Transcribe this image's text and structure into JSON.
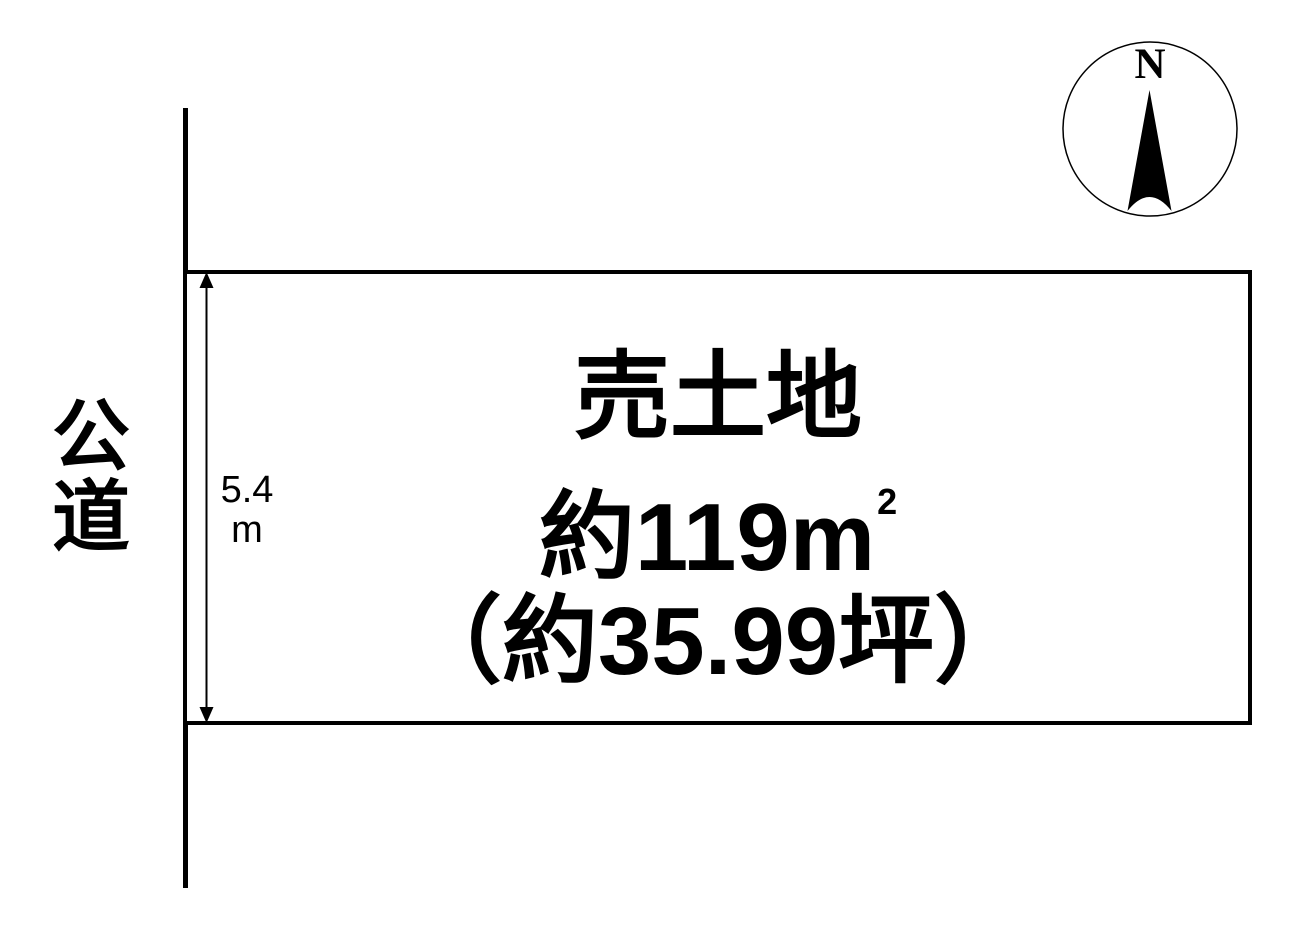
{
  "plot": {
    "title": "売土地",
    "area_main": "約119m",
    "area_sup": "2",
    "area_tsubo": "（約35.99坪）"
  },
  "road": {
    "label": "公道"
  },
  "dimension": {
    "value": "5.4",
    "unit": "m"
  },
  "compass": {
    "north_label": "N"
  },
  "colors": {
    "line": "#000000",
    "background": "#ffffff"
  }
}
